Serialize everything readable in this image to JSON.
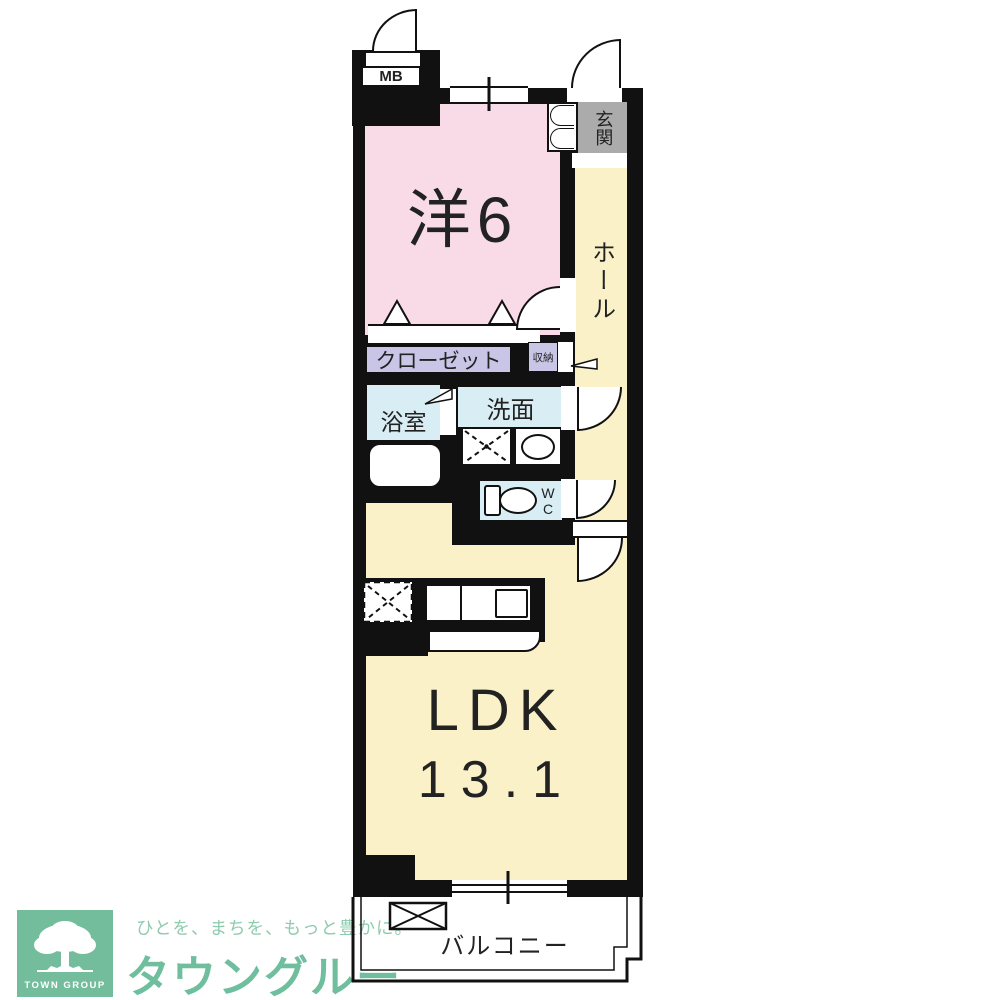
{
  "floorplan": {
    "meter_box": {
      "label": "MB"
    },
    "entrance": {
      "label": "玄関"
    },
    "hall": {
      "label": "ホール"
    },
    "western_room": {
      "label": "洋6"
    },
    "closet": {
      "label": "クローゼット"
    },
    "storage": {
      "label": "収納"
    },
    "bathroom": {
      "label": "浴室"
    },
    "washroom": {
      "label": "洗面"
    },
    "toilet": {
      "label": "WC"
    },
    "ldk": {
      "label": "LDK",
      "area": "13.1"
    },
    "balcony": {
      "label": "バルコニー"
    },
    "colors": {
      "wall": "#111111",
      "western_room": "#F8DBE7",
      "hall_ldk": "#FAF1C9",
      "closet": "#C9C5E7",
      "wet_area": "#D9EDF4",
      "entrance_floor": "#ABABAB"
    }
  },
  "footer": {
    "logo_square_label": "TOWN GROUP",
    "tagline": "ひとを、まちを、もっと豊かに。",
    "brand": "タウングループ",
    "brand_color": "#6FBE9E",
    "logo_green": "#74BD9C"
  }
}
